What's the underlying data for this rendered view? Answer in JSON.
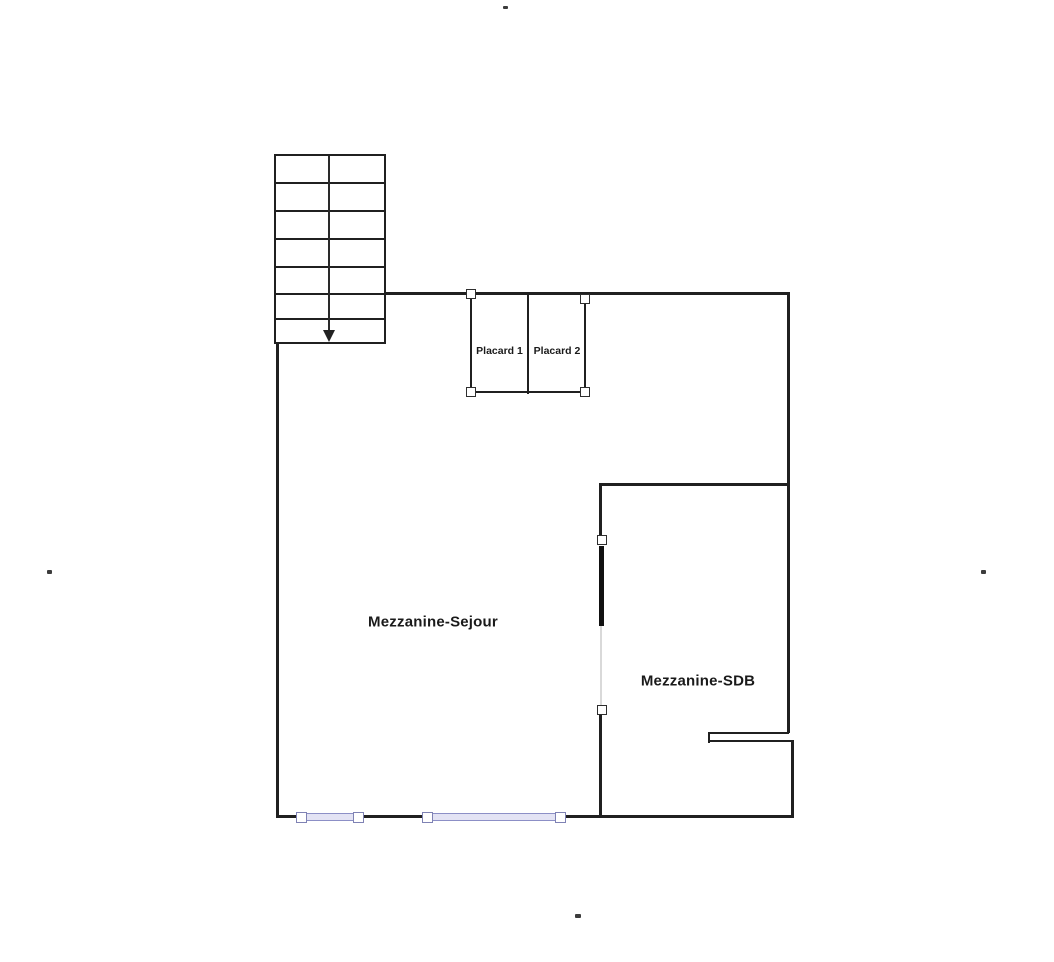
{
  "plan": {
    "rooms": [
      {
        "label": "Mezzanine-Sejour"
      },
      {
        "label": "Mezzanine-SDB"
      }
    ],
    "closets": [
      {
        "label": "Placard 1"
      },
      {
        "label": "Placard 2"
      }
    ],
    "stairs": {
      "direction": "down-arrow",
      "steps": 7
    }
  },
  "colors": {
    "wall": "#202020",
    "text": "#1a1a1a",
    "window_line": "#8c8fc6",
    "window_fill": "#e3e3f4",
    "handle_border_dark": "#2e2e2e",
    "handle_border_window": "#7f82b4",
    "door_track": "#d9d9d9",
    "background": "#ffffff"
  }
}
